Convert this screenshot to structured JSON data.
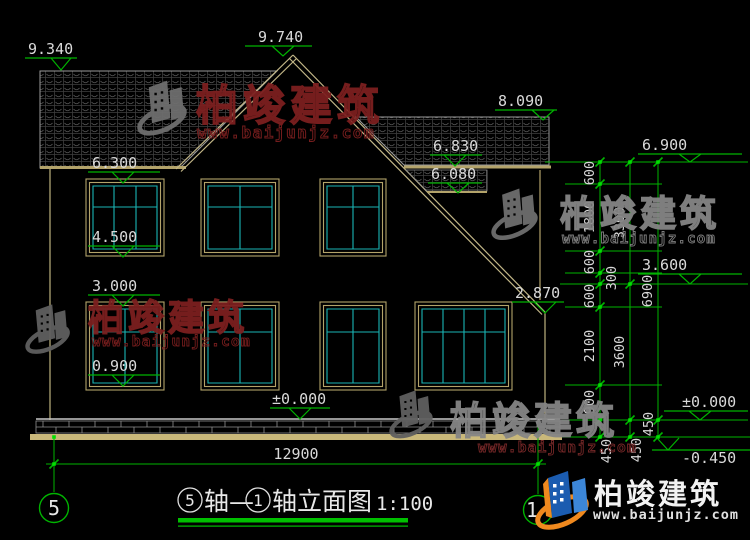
{
  "drawing": {
    "title": {
      "bubble_left": "5",
      "segment1": "轴—",
      "bubble_right": "1",
      "suffix": "轴立面图",
      "scale": "1:100"
    },
    "axis_bubbles": {
      "left": "5",
      "right": "1"
    },
    "total_width_dim": "12900",
    "elevation_marks": {
      "left_ridge": "9.340",
      "peak": "9.740",
      "floor2_window_top": "6.300",
      "floor2_window_sill": "4.500",
      "floor1_window_top": "3.000",
      "floor1_window_sill": "0.900",
      "ground_center": "±0.000",
      "right_ridge": "8.090",
      "right_eave": "6.830",
      "right_soffit": "6.080",
      "slope_end": "2.870",
      "eave_right": "6.900",
      "mid_right": "3.600",
      "ground_right": "±0.000",
      "footing_right": "-0.450"
    },
    "dim_chain_inner": [
      "600",
      "1800",
      "600",
      "300",
      "600",
      "2100",
      "900",
      "450"
    ],
    "dim_chain_middle": [
      "3300",
      "3600",
      "450"
    ],
    "dim_chain_outer": [
      "6900",
      "450"
    ]
  },
  "watermark": {
    "brand": "柏竣建筑",
    "website": "www.baijunjz.com"
  },
  "footer_logo": {
    "brand": "柏竣建筑",
    "website": "www.baijunjz.com"
  },
  "colors": {
    "background": "#000000",
    "dimension_green": "#00b300",
    "snap_green": "#00e000",
    "window_cyan": "#1ab5b5",
    "frame_tan": "#b3a36a",
    "ground_band_tan": "#c9b87a",
    "line_white": "#c8c8c8",
    "text_white": "#d9d9d9",
    "watermark_red": "#7c1f1f",
    "watermark_grey": "#858585",
    "logo_blue": "#1b5cb0",
    "logo_orange": "#f0891e"
  }
}
